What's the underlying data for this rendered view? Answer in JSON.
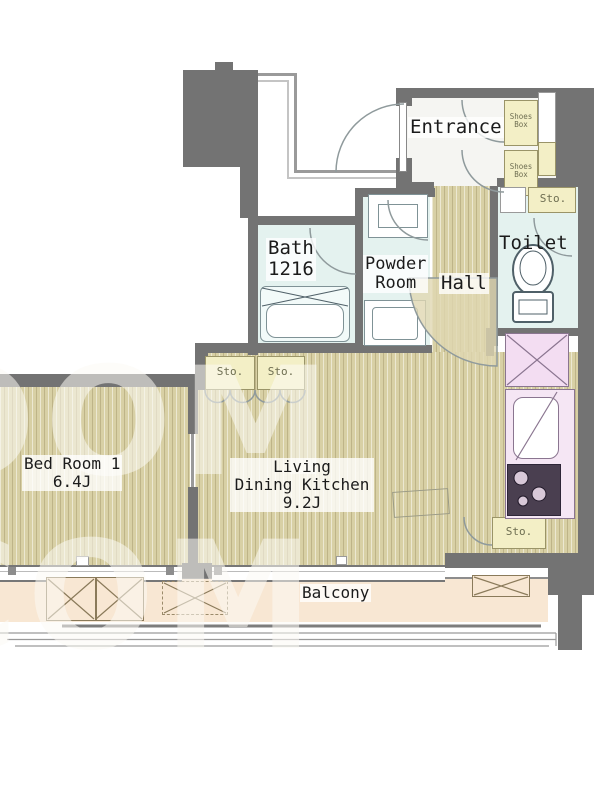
{
  "labels": {
    "entrance": "Entrance",
    "shoes_1": "Shoes",
    "shoes_2": "Box",
    "sto": "Sto.",
    "toilet": "Toilet",
    "bath_name": "Bath",
    "bath_size": "1216",
    "powder_1": "Powder",
    "powder_2": "Room",
    "hall": "Hall",
    "bedroom_name": "Bed Room 1",
    "bedroom_size": "6.4J",
    "ldk_1": "Living",
    "ldk_2": "Dining Kitchen",
    "ldk_size": "9.2J",
    "balcony": "Balcony",
    "watermark": "OOM COM"
  },
  "colors": {
    "wall": "#737373",
    "wood_floor": "#d8d0a5",
    "wet_floor": "#e4f2ef",
    "entrance_floor": "#f5f5f2",
    "storage_yellow": "#f3efc6",
    "kitchen_pink": "#f5e6f4",
    "balcony_floor": "#f8e7d3",
    "fixture_outline": "#7f9296",
    "watermark": "rgba(252,250,244,0.55)"
  }
}
